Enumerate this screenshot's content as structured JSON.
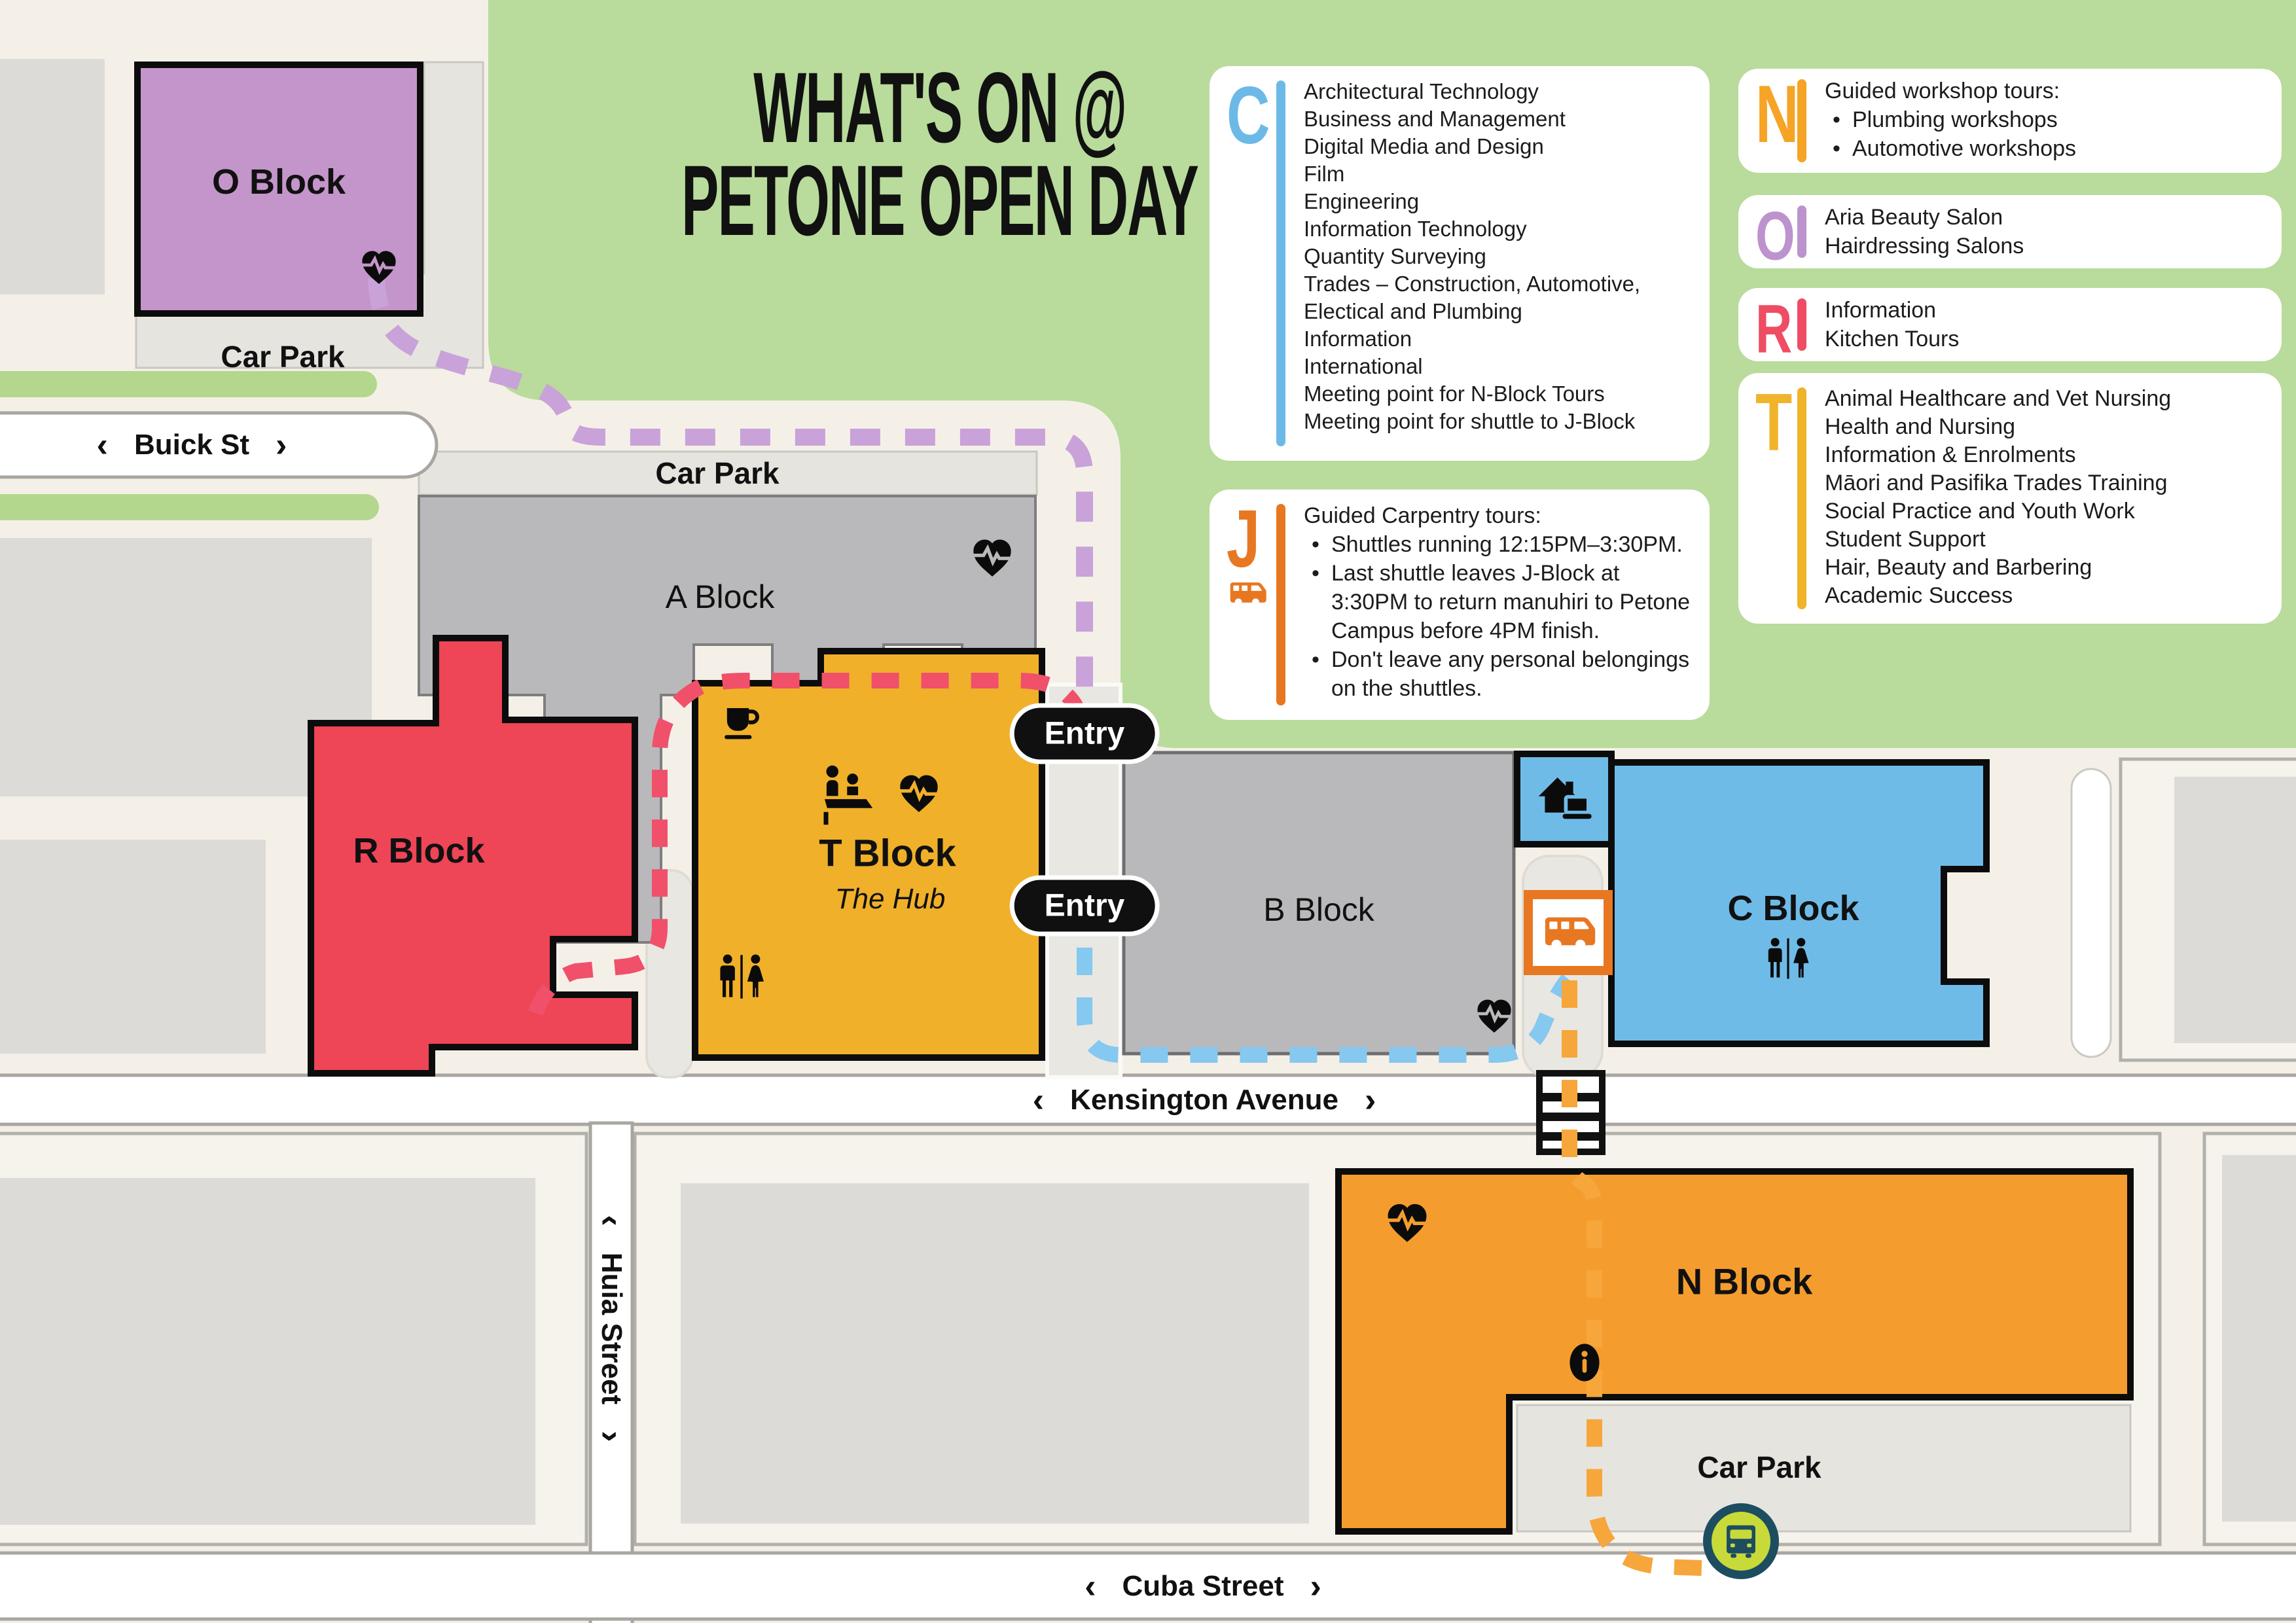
{
  "title": {
    "line1": "WHAT'S ON @",
    "line2": "PETONE OPEN DAY"
  },
  "legend": {
    "c": {
      "letter": "C",
      "color": "#6cb9e8",
      "lines": [
        "Architectural Technology",
        "Business and Management",
        "Digital Media and Design",
        "Film",
        "Engineering",
        "Information Technology",
        "Quantity Surveying",
        "Trades – Construction, Automotive,",
        "Electical and Plumbing",
        "Information",
        "International",
        "Meeting point for N-Block Tours",
        "Meeting point for shuttle to J-Block"
      ]
    },
    "j": {
      "letter": "J",
      "color": "#e87722",
      "heading": "Guided Carpentry tours:",
      "bullets": [
        "Shuttles running 12:15PM–3:30PM.",
        "Last shuttle leaves J-Block at 3:30PM to return manuhiri to Petone Campus before 4PM finish.",
        "Don't leave any personal belongings on the shuttles."
      ]
    },
    "n": {
      "letter": "N",
      "color": "#f5a426",
      "heading": "Guided workshop tours:",
      "bullets": [
        "Plumbing workshops",
        "Automotive workshops"
      ]
    },
    "o": {
      "letter": "O",
      "color": "#bd93cd",
      "lines": [
        "Aria Beauty Salon",
        "Hairdressing Salons"
      ]
    },
    "r": {
      "letter": "R",
      "color": "#ef4d63",
      "lines": [
        "Information",
        "Kitchen Tours"
      ]
    },
    "t": {
      "letter": "T",
      "color": "#f0b42a",
      "lines": [
        "Animal Healthcare and Vet Nursing",
        "Health and Nursing",
        "Information & Enrolments",
        "Māori and Pasifika Trades Training",
        "Social Practice and Youth Work",
        "Student Support",
        "Hair, Beauty and Barbering",
        "Academic Success"
      ]
    }
  },
  "map": {
    "blocks": {
      "o": {
        "label": "O Block",
        "color": "#c495cb"
      },
      "a": {
        "label": "A Block",
        "color": "#b9b9bb"
      },
      "r": {
        "label": "R Block",
        "color": "#ee4557"
      },
      "t": {
        "label": "T Block",
        "subtitle": "The Hub",
        "color": "#f0b02a"
      },
      "b": {
        "label": "B Block",
        "color": "#b9b9bb"
      },
      "c": {
        "label": "C Block",
        "color": "#6fbbe8"
      },
      "n": {
        "label": "N Block",
        "color": "#f49d2e"
      }
    },
    "car_park_label": "Car Park",
    "entry_label": "Entry",
    "streets": {
      "buick": "Buick St",
      "kensington": "Kensington Avenue",
      "huia": "Huia Street",
      "cuba": "Cuba Street"
    },
    "path_colors": {
      "purple": "#c9a2d9",
      "pink": "#f0506a",
      "blue": "#85c8f0",
      "orange": "#f6a63a"
    },
    "surface_colors": {
      "green": "#b9db9b",
      "grass": "#b3d78c",
      "cream": "#f6f3ec",
      "street": "#ffffff",
      "car_park": "#e6e4df",
      "building": "#dcdbd8"
    },
    "icons": {
      "chevron_left": "‹",
      "chevron_right": "›"
    },
    "bus_stop_colors": {
      "ring": "#1d4d60",
      "inner": "#c8da3a"
    }
  }
}
